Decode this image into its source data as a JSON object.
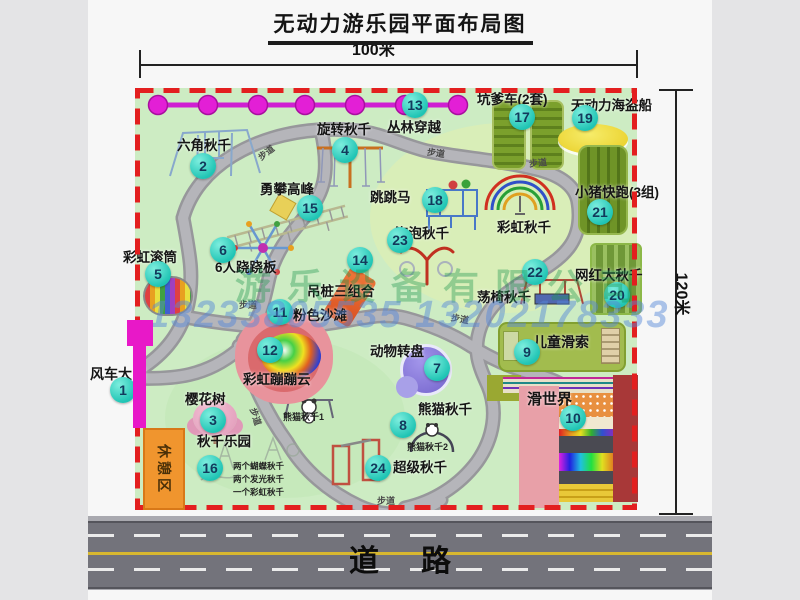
{
  "title": "无动力游乐园平面布局图",
  "dim_top": "100米",
  "dim_right": "120米",
  "road_label": "道路",
  "walkway": "步道",
  "rest_area": "休憩区",
  "rainbow_swing": "彩虹秋千",
  "panda1": "熊猫秋千1",
  "panda2": "熊猫秋千2",
  "swing_notes": [
    "两个蝴蝶秋千",
    "两个发光秋千",
    "一个彩虹秋千"
  ],
  "watermark": {
    "company": "游乐设备有限公司",
    "phone": "13233805535 13202178333"
  },
  "colors": {
    "badge": "#1fc4b4",
    "border_dash": "#e31f1f",
    "chain": "#e31fd6",
    "gate": "#e818c8",
    "rest_area_bg": "#f0952e",
    "road_yellow": "#d8b830"
  },
  "locations": {
    "1": {
      "num": "1",
      "label": "风车大门"
    },
    "2": {
      "num": "2",
      "label": "六角秋千"
    },
    "3": {
      "num": "3",
      "label": "樱花树"
    },
    "4": {
      "num": "4",
      "label": "旋转秋千"
    },
    "5": {
      "num": "5",
      "label": "彩虹滚筒"
    },
    "6": {
      "num": "6",
      "label": "6人跷跷板"
    },
    "7": {
      "num": "7",
      "label": "动物转盘"
    },
    "8": {
      "num": "8",
      "label": "熊猫秋千"
    },
    "9": {
      "num": "9",
      "label": "儿童滑索"
    },
    "10": {
      "num": "10",
      "label": "滑世界"
    },
    "11": {
      "num": "11",
      "label": "粉色沙滩"
    },
    "12": {
      "num": "12",
      "label": "彩虹蹦蹦云"
    },
    "13": {
      "num": "13",
      "label": "丛林穿越"
    },
    "14": {
      "num": "14",
      "label": "吊桩三组合"
    },
    "15": {
      "num": "15",
      "label": "勇攀高峰"
    },
    "16": {
      "num": "16",
      "label": "秋千乐园"
    },
    "17": {
      "num": "17",
      "label": "坑爹车(2套)"
    },
    "18": {
      "num": "18",
      "label": "跳跳马"
    },
    "19": {
      "num": "19",
      "label": "无动力海盗船"
    },
    "20": {
      "num": "20",
      "label": "网红大秋千"
    },
    "21": {
      "num": "21",
      "label": "小猪快跑(3组)"
    },
    "22": {
      "num": "22",
      "label": "荡椅秋千"
    },
    "23": {
      "num": "23",
      "label": "泡泡秋千"
    },
    "24": {
      "num": "24",
      "label": "超级秋千"
    }
  }
}
